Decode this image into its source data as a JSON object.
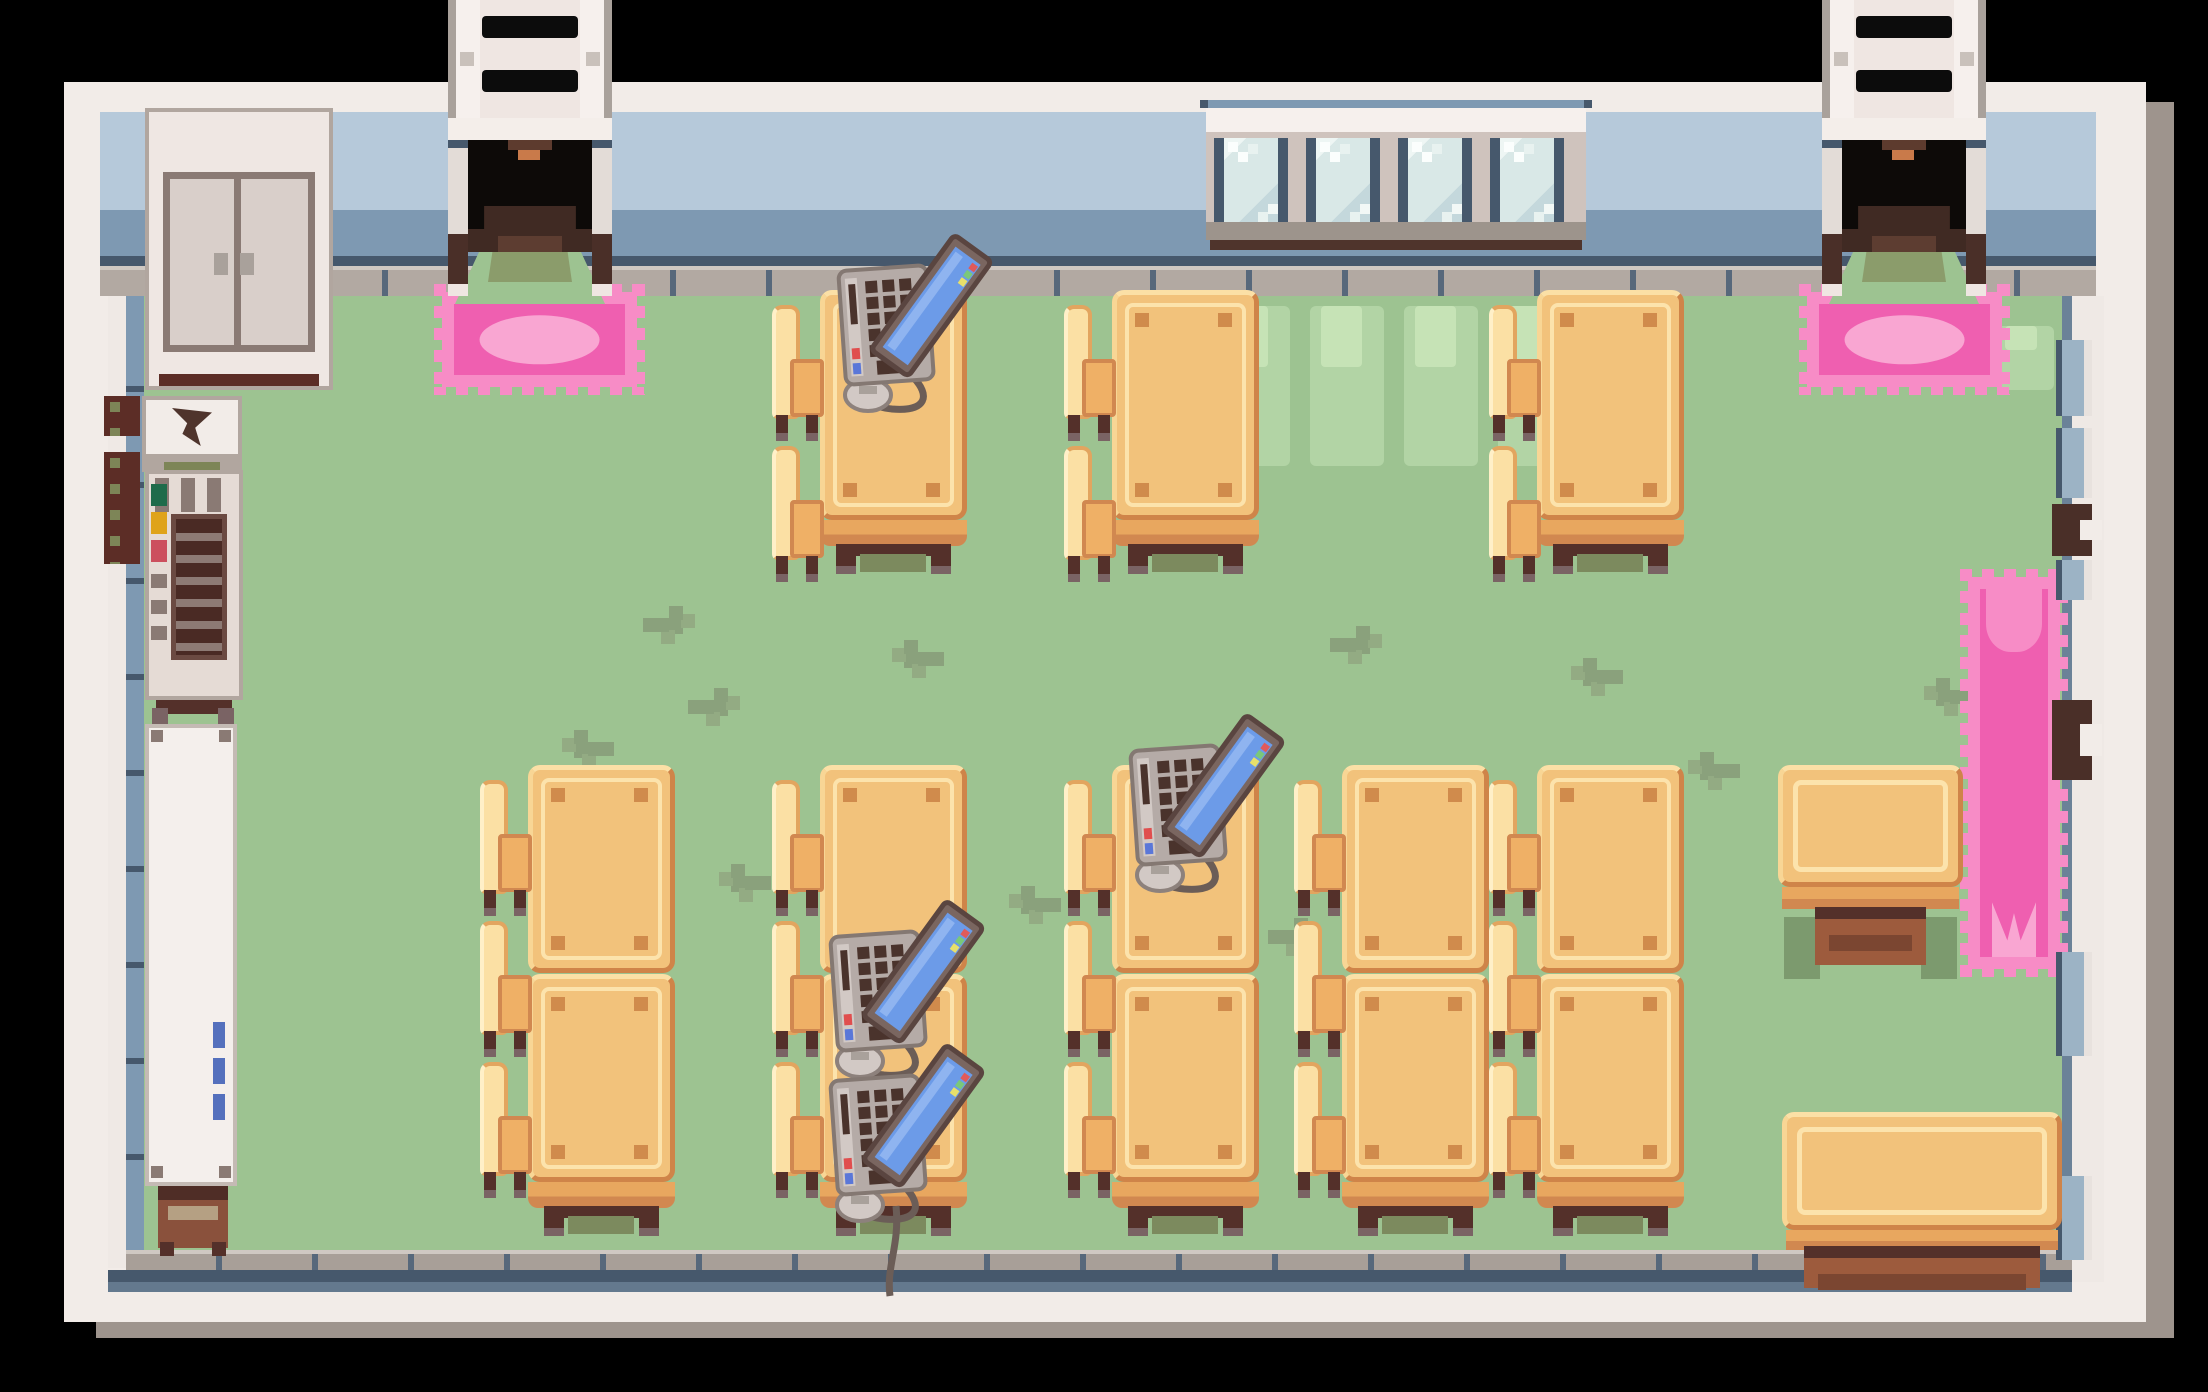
{
  "meta": {
    "app": "top-down pixel-art RPG interior",
    "room": "school classroom / computer lab",
    "visible_text": ""
  },
  "palette": {
    "outside_black": "#000000",
    "border_cream": "#f2ece8",
    "border_shadow": "#9e948d",
    "wall_blue_light": "#b6c9da",
    "wall_blue_dark": "#7e99b2",
    "navy_trim": "#46586c",
    "baseboard_gray": "#b2a9a2",
    "floor_green": "#9dc391",
    "floor_scuff": "#8aa17c",
    "floor_light": "#b2d4a5",
    "desk_wood": "#f2c27b",
    "desk_wood_light": "#fbe0a4",
    "desk_wood_dark": "#d18850",
    "leg_brown": "#54302a",
    "rug_pink": "#ef5fb0",
    "rug_pink_border": "#f78cc6",
    "rug_pink_light": "#f9a6d2",
    "laptop_body": "#b5aba7",
    "laptop_screen": "#6c9be8",
    "window_glass": "#d9e8e7",
    "doorway_black": "#0d0a08"
  },
  "scene": {
    "stairs": [
      {
        "x": 448
      },
      {
        "x": 1822
      }
    ],
    "doorways": [
      {
        "x": 448
      },
      {
        "x": 1822
      }
    ],
    "doormats": [
      {
        "x": 442,
        "y": 292,
        "w": 195,
        "h": 95
      },
      {
        "x": 1807,
        "y": 292,
        "w": 195,
        "h": 95
      }
    ],
    "runner_rug": {
      "x": 1968,
      "y": 577,
      "w": 92,
      "h": 392
    },
    "window_group": {
      "x": 1206,
      "y": 100,
      "panes": 4
    },
    "desks": [
      {
        "x": 820,
        "y": 290,
        "panels": 1,
        "chairs": 2
      },
      {
        "x": 1112,
        "y": 290,
        "panels": 1,
        "chairs": 2
      },
      {
        "x": 1537,
        "y": 290,
        "panels": 1,
        "chairs": 2
      },
      {
        "x": 528,
        "y": 765,
        "panels": 2,
        "chairs": 3
      },
      {
        "x": 820,
        "y": 765,
        "panels": 2,
        "chairs": 3
      },
      {
        "x": 1112,
        "y": 765,
        "panels": 2,
        "chairs": 3
      },
      {
        "x": 1342,
        "y": 765,
        "panels": 2,
        "chairs": 3
      },
      {
        "x": 1537,
        "y": 765,
        "panels": 2,
        "chairs": 3
      }
    ],
    "laptops": [
      {
        "x": 834,
        "y": 246
      },
      {
        "x": 1126,
        "y": 726
      },
      {
        "x": 826,
        "y": 912
      },
      {
        "x": 826,
        "y": 1056,
        "tail": true
      }
    ],
    "side_table": {
      "x": 1778,
      "y": 765,
      "w": 185,
      "h": 122
    },
    "bench": {
      "x": 1782,
      "y": 1112,
      "w": 280,
      "h": 118
    },
    "wall_fittings_right": [
      {
        "y": 340,
        "h": 76,
        "kind": "pane"
      },
      {
        "y": 428,
        "h": 70,
        "kind": "pane"
      },
      {
        "y": 504,
        "h": 52,
        "kind": "latch"
      },
      {
        "y": 560,
        "h": 40,
        "kind": "pane"
      },
      {
        "y": 700,
        "h": 80,
        "kind": "latch"
      },
      {
        "y": 952,
        "h": 104,
        "kind": "pane"
      },
      {
        "y": 1176,
        "h": 84,
        "kind": "pane"
      }
    ],
    "wall_boxes_left": [
      {
        "y": 396,
        "h": 40
      },
      {
        "y": 452,
        "h": 112
      }
    ],
    "grass_decals": [
      [
        655,
        618
      ],
      [
        918,
        652
      ],
      [
        1342,
        638
      ],
      [
        1597,
        670
      ],
      [
        864,
        790
      ],
      [
        1138,
        806
      ],
      [
        1446,
        788
      ],
      [
        1714,
        764
      ],
      [
        700,
        700
      ],
      [
        1035,
        898
      ],
      [
        1280,
        930
      ],
      [
        1950,
        690
      ],
      [
        1868,
        934
      ],
      [
        588,
        742
      ],
      [
        2008,
        616
      ],
      [
        745,
        876
      ]
    ],
    "light_patches": [
      {
        "x": 1216,
        "y": 306,
        "w": 74,
        "h": 160
      },
      {
        "x": 1310,
        "y": 306,
        "w": 74,
        "h": 160
      },
      {
        "x": 1404,
        "y": 306,
        "w": 74,
        "h": 160
      },
      {
        "x": 1498,
        "y": 306,
        "w": 74,
        "h": 160
      },
      {
        "x": 1996,
        "y": 326,
        "w": 58,
        "h": 64
      },
      {
        "x": 1964,
        "y": 338,
        "w": 22,
        "h": 44
      }
    ]
  }
}
